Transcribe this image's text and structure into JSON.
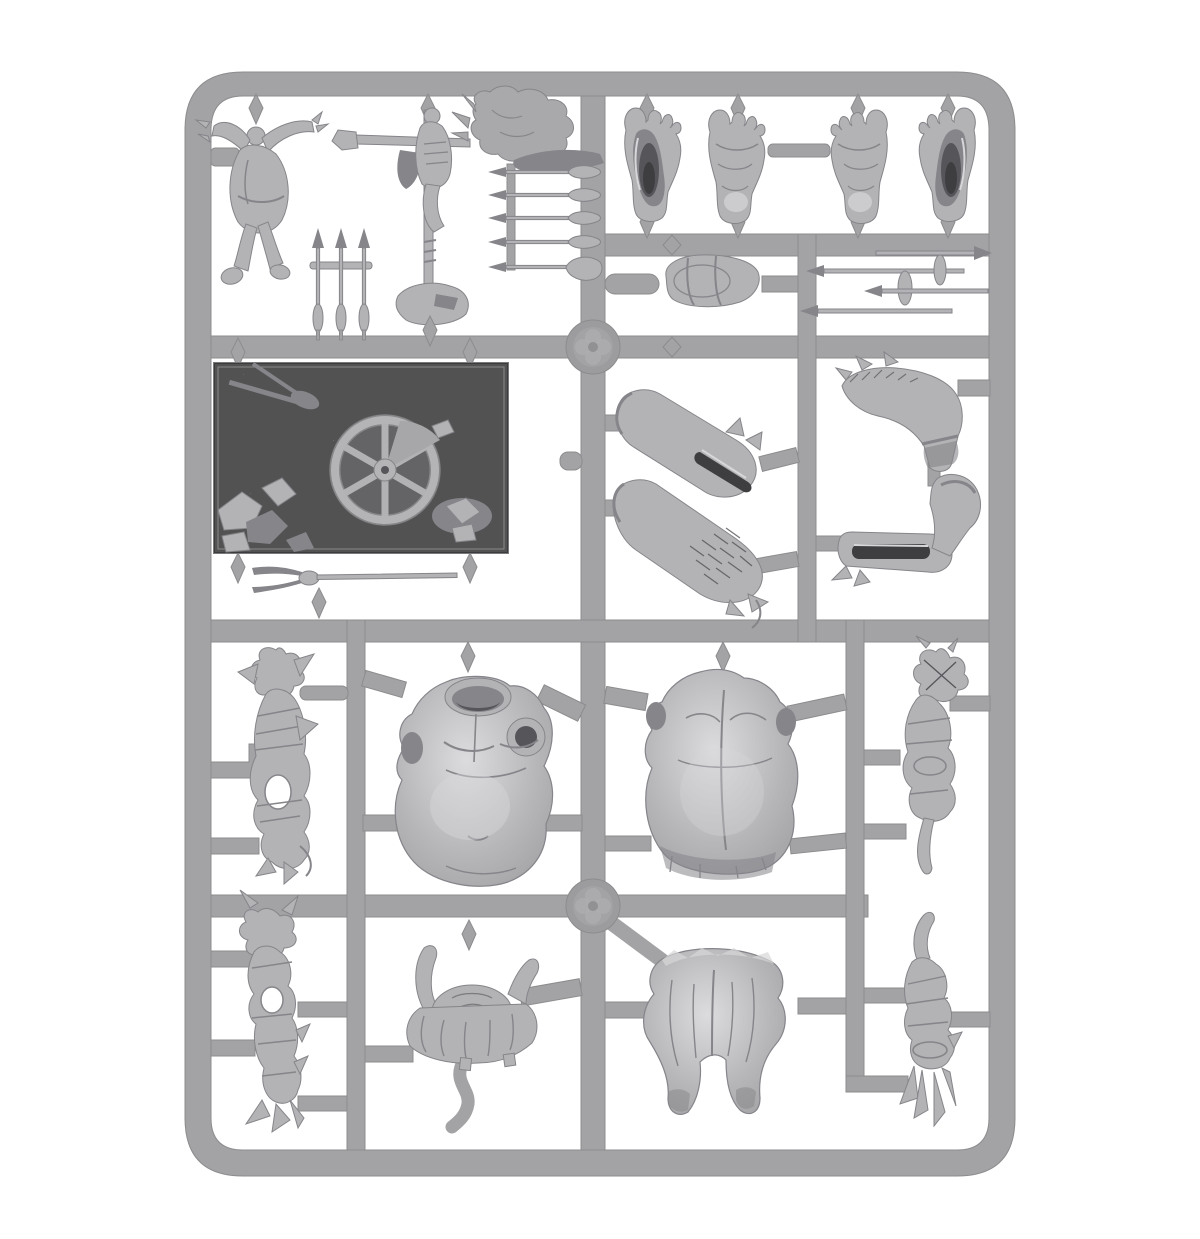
{
  "palette": {
    "background": "#ffffff",
    "rail": "#a3a3a5",
    "railEdge": "#8c8c8e",
    "hub": "#9c9c9e",
    "part": "#b3b3b5",
    "partLight": "#d7d7d9",
    "partShadow": "#85858a",
    "partDeep": "#55555a",
    "slot": "#3e3e41",
    "plate": "#a7a7a9",
    "plateEdge": "#7a7a7d",
    "relief": "#a9a9ab"
  },
  "parts": [
    {
      "id": "hanged-figure",
      "label": "hanged-figure"
    },
    {
      "id": "trophy-standard",
      "label": "trophy-standard-pole"
    },
    {
      "id": "flattened-figure-relief",
      "label": "flattened-figure-relief"
    },
    {
      "id": "scythe-blade",
      "label": "scythe-blade"
    },
    {
      "id": "arrow-triplet",
      "label": "three-arrows"
    },
    {
      "id": "spear-row",
      "label": "five-spears"
    },
    {
      "id": "giant-foot-sole-left",
      "label": "giant-foot-sole"
    },
    {
      "id": "giant-foot-top-left",
      "label": "giant-foot-top"
    },
    {
      "id": "giant-foot-top-right",
      "label": "giant-foot-top"
    },
    {
      "id": "giant-foot-sole-right",
      "label": "giant-foot-sole"
    },
    {
      "id": "vambrace",
      "label": "wrist-bracer"
    },
    {
      "id": "spear-pair-left",
      "label": "crossed-spears"
    },
    {
      "id": "spear-pair-right",
      "label": "crossed-spears"
    },
    {
      "id": "scenic-base",
      "label": "scenic-base-with-cartwheel"
    },
    {
      "id": "two-prong-fork",
      "label": "two-pronged-fork"
    },
    {
      "id": "arm-upper-left",
      "label": "giant-arm-with-socket"
    },
    {
      "id": "arm-lower-left",
      "label": "giant-arm-mail-sleeve"
    },
    {
      "id": "arm-upper-right",
      "label": "giant-bent-arm"
    },
    {
      "id": "arm-lower-right",
      "label": "giant-bent-arm-with-socket"
    },
    {
      "id": "torso-front",
      "label": "giant-torso-front"
    },
    {
      "id": "torso-back",
      "label": "giant-torso-back"
    },
    {
      "id": "carcass-sack-upper-left",
      "label": "wrapped-carcass-sack"
    },
    {
      "id": "carcass-sack-lower-left",
      "label": "spiked-carcass-sack"
    },
    {
      "id": "cape-drape",
      "label": "draped-cloth-cape"
    },
    {
      "id": "loincloth",
      "label": "giant-breeches"
    },
    {
      "id": "carcass-bundle-upper-right",
      "label": "bundled-carcass"
    },
    {
      "id": "carcass-bundle-lower-right",
      "label": "bundled-carcass"
    }
  ]
}
